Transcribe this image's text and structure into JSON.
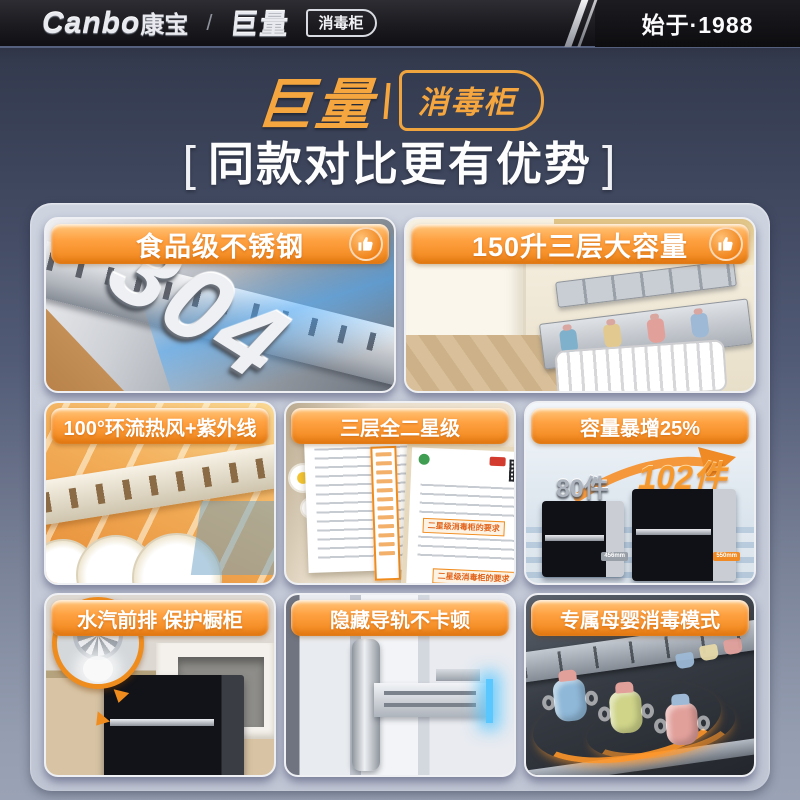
{
  "header": {
    "logo_latin": "Canbo",
    "logo_cn": "康宝",
    "divider": "/",
    "brand": "巨量",
    "brand_sub": "消毒柜",
    "since": "始于·1988"
  },
  "hero": {
    "brand": "巨量",
    "brand_sub": "消毒柜",
    "bracket_l": "[",
    "title": "同款对比更有优势",
    "bracket_r": "]"
  },
  "colors": {
    "accent_orange": "#f08c1e",
    "badge_gold": "#f5a63f",
    "panel_gray": "#c6ccd9",
    "glow_blue": "#5ac8ff"
  },
  "cards": [
    {
      "label": "食品级不锈钢",
      "icon": "thumbs-up-icon",
      "steel_number": "304"
    },
    {
      "label": "150升三层大容量",
      "icon": "thumbs-up-icon"
    },
    {
      "label": "100°环流热风+紫外线"
    },
    {
      "label": "三层全二星级",
      "cert_box_text": "二星级消毒柜的要求"
    },
    {
      "label": "容量暴增25%",
      "small_label": "80件",
      "big_label": "102件",
      "small_tag": "456mm",
      "big_tag": "550mm"
    },
    {
      "label": "水汽前排 保护橱柜"
    },
    {
      "label": "隐藏导轨不卡顿"
    },
    {
      "label": "专属母婴消毒模式"
    }
  ]
}
